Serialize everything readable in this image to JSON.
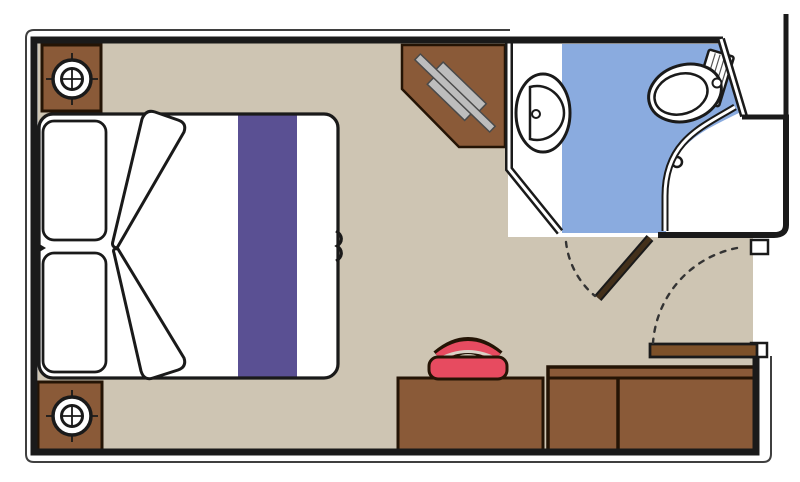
{
  "view": {
    "label": "cruise-cabin-floor-plan",
    "width": 800,
    "height": 482
  },
  "colors": {
    "page_bg": "#ffffff",
    "white": "#ffffff",
    "wall": "#1a1a1a",
    "thin_line": "#3f3f3f",
    "floor": "#cec5b3",
    "bath_blue": "#8aabdf",
    "runner_purple": "#5a5093",
    "furniture_brown": "#8a5a38",
    "outline": "#241405",
    "bath_door_brown": "#43301b",
    "entry_door_brown": "#7d5129",
    "stool_red": "#e74b60",
    "stool_gap": "#d9d2c6",
    "tv_gray": "#bdbdbd",
    "tv_outline": "#4a4a4a",
    "fixture_stroke": "#1a1a1a",
    "dash": "#333333"
  },
  "items": {
    "bed": "double-bed",
    "pillows": [
      "pillow-top",
      "pillow-bottom"
    ],
    "runner": "bed-runner",
    "folds": [
      "blanket-fold-top",
      "blanket-fold-bottom"
    ],
    "cabinets": [
      "bedside-cabinet-top",
      "bedside-cabinet-bottom"
    ],
    "vanity": "tv-cabinet",
    "tv": "tv",
    "bathroom": "bathroom",
    "sink": "washbasin",
    "toilet": "toilet",
    "shower": "shower",
    "desk": "desk",
    "stool": "stool",
    "wardrobe": "wardrobe",
    "doors": [
      "bathroom-door",
      "entrance-door"
    ]
  }
}
